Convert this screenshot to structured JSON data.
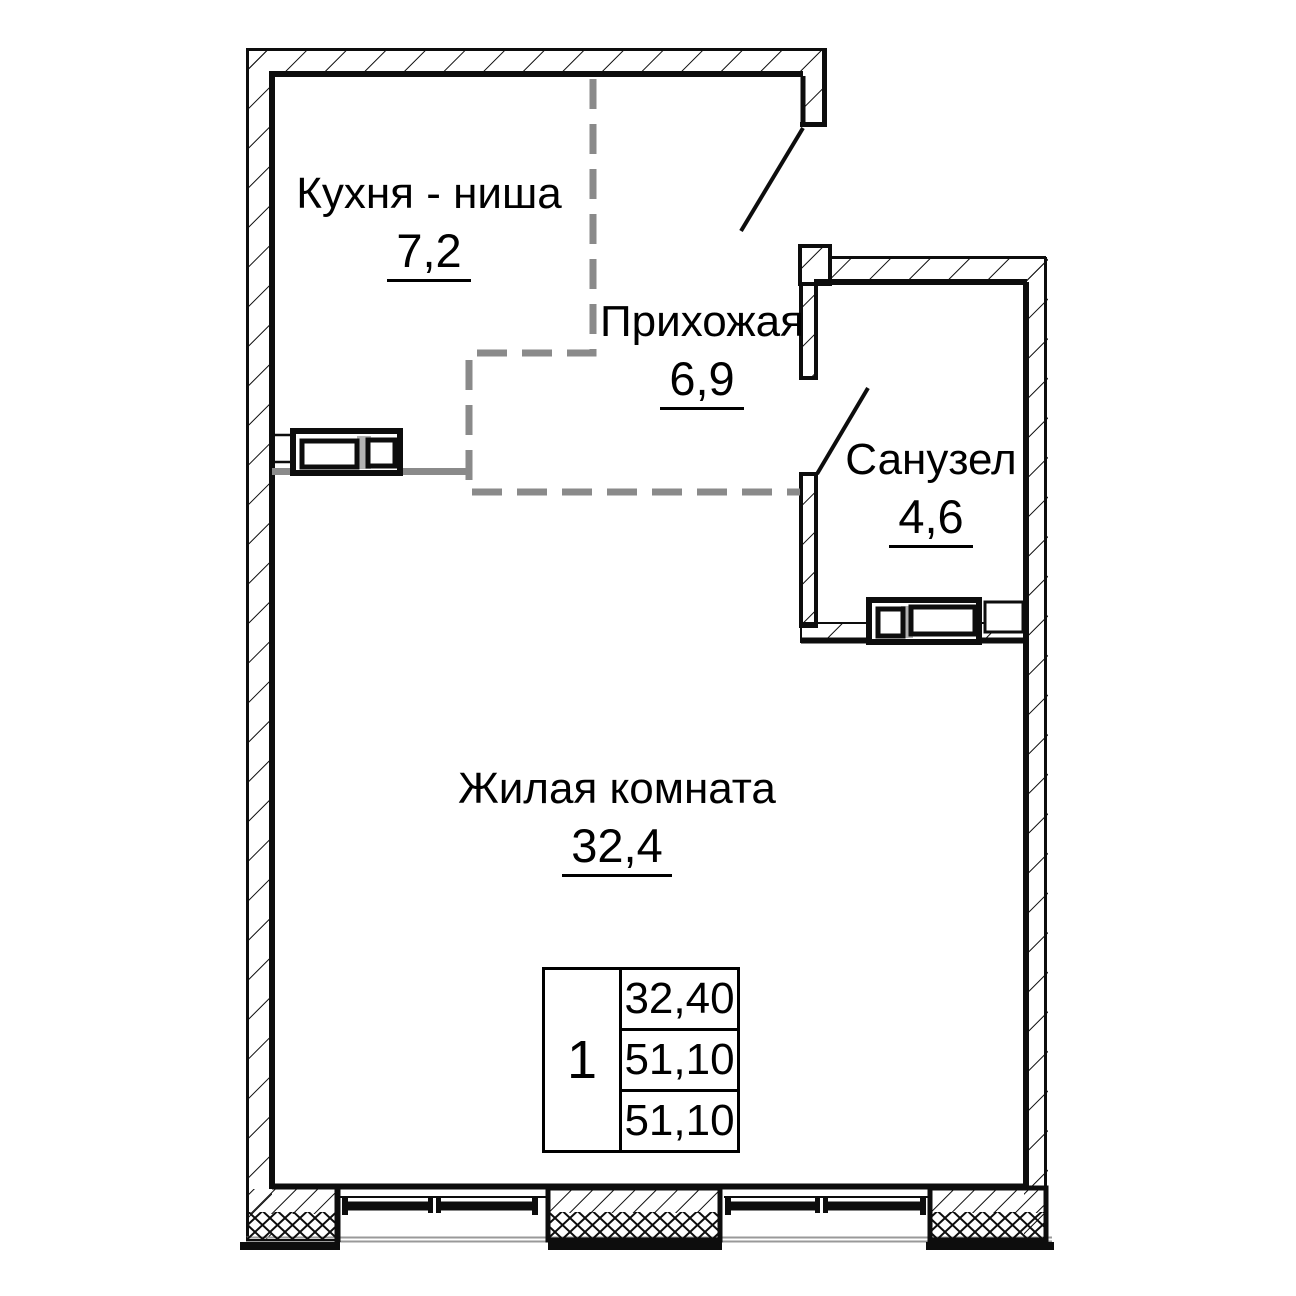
{
  "plan": {
    "rooms": [
      {
        "id": "kitchen",
        "name": "Кухня - ниша",
        "area": "7,2"
      },
      {
        "id": "hallway",
        "name": "Прихожая",
        "area": "6,9"
      },
      {
        "id": "bathroom",
        "name": "Санузел",
        "area": "4,6"
      },
      {
        "id": "living",
        "name": "Жилая комната",
        "area": "32,4"
      }
    ],
    "stamp": {
      "rooms_count": "1",
      "areas": [
        "32,40",
        "51,10",
        "51,10"
      ]
    },
    "colors": {
      "line": "#0d0d0d",
      "zone_dash": "#8a8a8a",
      "fixture_gap": "#b3b3b3",
      "background": "#ffffff"
    }
  }
}
